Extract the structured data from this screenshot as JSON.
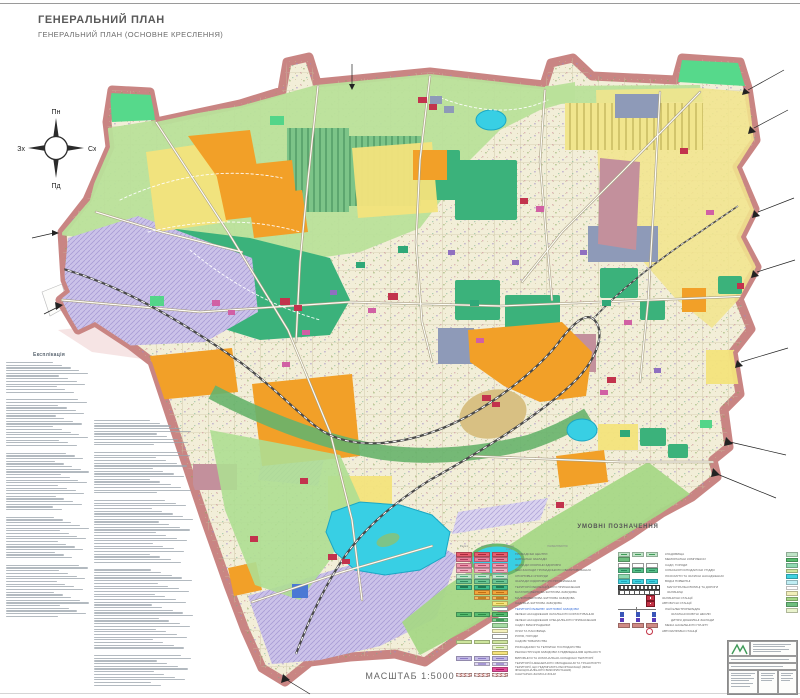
{
  "header": {
    "title": "ГЕНЕРАЛЬНИЙ ПЛАН",
    "subtitle": "ГЕНЕРАЛЬНИЙ ПЛАН (ОСНОВНЕ КРЕСЛЕННЯ)"
  },
  "compass": {
    "north": "Пн",
    "south": "Пд",
    "east": "Сх",
    "west": "Зх"
  },
  "explication": {
    "title": "Експлікація",
    "col1_blocks": [
      12,
      18,
      22,
      16,
      20
    ],
    "col2_blocks": [
      10,
      16,
      24,
      30,
      12
    ]
  },
  "scale": {
    "label": "МАСШТАБ 1:5000"
  },
  "legend": {
    "title": "УМОВНІ ПОЗНАЧЕННЯ",
    "col_headers": [
      "існуючі",
      "на I чергу",
      "на розрах. строк"
    ],
    "label_header": "НАЙМЕНУВАННЯ",
    "left_rows": [
      {
        "c": "#e85d6e",
        "d": "#a8293c",
        "f": [
          1,
          1,
          1
        ],
        "label": "ГРОМАДСЬКІ ЦЕНТРИ"
      },
      {
        "c": "#e87d97",
        "d": "#b03b5c",
        "f": [
          1,
          1,
          1
        ],
        "label": "НАВЧАЛЬНІ ЗАКЛАДИ"
      },
      {
        "c": "#ef97ad",
        "d": "#b8496a",
        "f": [
          1,
          1,
          1
        ],
        "label": "ЗАКЛАДИ ОХОРОНИ ЗДОРОВ'Я"
      },
      {
        "c": "#f3aec0",
        "d": "#c05a78",
        "f": [
          1,
          1,
          1
        ],
        "label": "ІНШІ ЗАКЛАДИ ГРОМАДСЬКОГО ОБСЛУГОВУВАННЯ"
      },
      {
        "c": "#bfe7cb",
        "d": "#4fae7a",
        "f": [
          1,
          1,
          1
        ],
        "label": "СПОРТИВНІ СПОРУДИ"
      },
      {
        "c": "#6cc795",
        "d": "#2f8a5e",
        "f": [
          1,
          1,
          1
        ],
        "label": "ЗАКЛАДИ ОЗДОРОВЧОГО ПРИЗНАЧЕННЯ"
      },
      {
        "c": "#3fbd8b",
        "d": "#1f7a52",
        "f": [
          1,
          1,
          1
        ],
        "label": "ТЕРИТОРІЇ РЕКРЕАЦІЙНОГО ПРИЗНАЧЕННЯ"
      },
      {
        "c": "#f2a43b",
        "d": "#c06f12",
        "f": [
          0,
          1,
          1
        ],
        "label": "БАГАТОПОВЕРХОВА ЖИТЛОВА ЗАБУДОВА"
      },
      {
        "c": "#f4b95c",
        "d": "#c5821f",
        "f": [
          0,
          1,
          1
        ],
        "label": "МАЛОПОВЕРХОВА ЖИТЛОВА ЗАБУДОВА"
      },
      {
        "c": "#f6e47c",
        "d": "#c9ae35",
        "f": [
          0,
          0,
          1
        ],
        "label": "САДИБНА ЖИТЛОВА ЗАБУДОВА"
      },
      {
        "c": "#ffffff",
        "d": "",
        "f": [
          0,
          0,
          1
        ],
        "blue": true,
        "label": "ТЕРИТОРІЇ РЕЗЕРВУ ЖИТЛОВОЇ ЗАБУДОВИ"
      },
      {
        "c": "#57bd6f",
        "d": "#2a8a45",
        "f": [
          1,
          1,
          1
        ],
        "label": "ЗЕЛЕНІ НАСАДЖЕННЯ ЗАГАЛЬНОГО КОРИСТУВАННЯ"
      },
      {
        "c": "#7fcf8f",
        "d": "#3f9a58",
        "f": [
          0,
          0,
          1
        ],
        "label": "ЗЕЛЕНІ НАСАДЖЕННЯ СПЕЦІАЛЬНОГО ПРИЗНАЧЕННЯ"
      },
      {
        "c": "#a6dba4",
        "d": "",
        "f": [
          0,
          0,
          1
        ],
        "label": "САДИ І ВИНОГРАДНИКИ"
      },
      {
        "c": "#f4f0bb",
        "d": "",
        "f": [
          0,
          0,
          1
        ],
        "label": "ЛУКИ ТА ПАСОВИЩА"
      },
      {
        "c": "#ffffff",
        "d": "",
        "f": [
          0,
          0,
          1
        ],
        "label": "РІЛЛЯ, ГОРОДИ"
      },
      {
        "c": "#cde59d",
        "d": "",
        "f": [
          1,
          1,
          1
        ],
        "label": "САДОВІ ТОВАРИСТВА"
      },
      {
        "c": "#e9f3cd",
        "d": "#9cc45e",
        "f": [
          0,
          0,
          1
        ],
        "label": "РОЗСАДНИКИ ТА ТЕПЛИЧНІ ГОСПОДАРСТВА"
      },
      {
        "c": "#f6e47c",
        "d": "",
        "f": [
          0,
          0,
          1
        ],
        "label": "РЕКОНСТРУКЦІЯ ЗАБУДОВИ З ПІДВИЩЕННЯМ ЩІЛЬНОСТІ"
      },
      {
        "c": "#c3b9e6",
        "d": "#8a7bc4",
        "f": [
          1,
          1,
          1
        ],
        "label": "ВИРОБНИЧІ ТА КОМУНАЛЬНО-СКЛАДСЬКІ ТЕРИТОРІЇ"
      },
      {
        "c": "#dcd4f0",
        "d": "#a697d4",
        "f": [
          0,
          1,
          1
        ],
        "label": "ТЕРИТОРІЇ ІНЖЕНЕРНОГО ОБЛАДНАННЯ ТА ТРАНСПОРТУ"
      },
      {
        "c": "#e34f9b",
        "d": "#a8165f",
        "f": [
          0,
          0,
          1
        ],
        "label": "ТЕРИТОРІЇ, ЩО ПІДЛЯГАЮТЬ РЕОРГАНІЗАЦІЇ (ЗМІНІ ФУНКЦІОНАЛЬНОГО ВИКОРИСТАННЯ)"
      },
      {
        "c": "#cf8a85",
        "d": "",
        "f": [
          1,
          1,
          1
        ],
        "hatch": true,
        "label": "САНІТАРНО-ЗАХИСНІ ЗОНИ"
      }
    ],
    "right_rows": [
      {
        "type": "sw3",
        "c": "#bfe4c7",
        "d": "#3f9a58",
        "label": "КЛАДОВИЩА"
      },
      {
        "type": "sw1",
        "c": "#6fbf7f",
        "d": "",
        "label": "МЕМОРІАЛЬНІ КОМПЛЕКСИ"
      },
      {
        "type": "sw3o",
        "c": "#ffffff",
        "d": "",
        "label": "САДИ, ГОРОДИ"
      },
      {
        "type": "sw3",
        "c": "#57c08a",
        "d": "#2a8a5e",
        "label": "СІЛЬСЬКОГОСПОДАРСЬКІ УГІДДЯ"
      },
      {
        "type": "sw1",
        "c": "#8fd9b0",
        "d": "",
        "label": "ЛІСОСМУГИ ТА ЗАХИСНІ НАСАДЖЕННЯ"
      },
      {
        "type": "sw3",
        "c": "#3fd2e0",
        "d": "#1fa8be",
        "label": "ВОДНІ ПОВЕРХНІ"
      },
      {
        "type": "road",
        "label": "МАГІСТРАЛЬНІ ВУЛИЦІ ТА ДОРОГИ"
      },
      {
        "type": "rail",
        "label": "ЗАЛІЗНИЦІ"
      },
      {
        "type": "sym",
        "label": "ЗАЛІЗНИЧНІ СТАНЦІЇ"
      },
      {
        "type": "sym",
        "label": "АВТОБУСНІ СТАНЦІЇ"
      },
      {
        "type": "line",
        "label": "ЛІНІЇ ЕЛЕКТРОПЕРЕДАЧ"
      },
      {
        "type": "sq",
        "c": "#3a55b8",
        "label": "ЗАГАЛЬНООСВІТНІ ШКОЛИ"
      },
      {
        "type": "sq",
        "c": "#5a3ab8",
        "label": "ДИТЯЧІ ДОШКІЛЬНІ ЗАКЛАДИ"
      },
      {
        "type": "border",
        "c": "#cf8a85",
        "label": "МЕЖА НАСЕЛЕНОГО ПУНКТУ"
      },
      {
        "type": "fuel",
        "label": "АВТОЗАПРАВНІ СТАНЦІЇ"
      }
    ],
    "extra_swatches": [
      "#bfe4c7",
      "#57bd6f",
      "#8fd9b0",
      "#cde59d",
      "#3fd2e0",
      "#bfeef4",
      "#ffffff",
      "#f2efb9",
      "#a6d787",
      "#6fbf7f",
      "#e9f3cd"
    ]
  },
  "map_colors": {
    "boundary_band": "#c98583",
    "base_fabric": "#f2eed8",
    "park_green": "#b9e09a",
    "forest_teal": "#3bb27b",
    "allotment_green": "#7cc488",
    "residential_yellow": "#f3e37c",
    "multistorey_orange": "#f2a028",
    "industrial_lavender": "#cbc2e9",
    "utility_slate": "#8e9ab8",
    "public_red": "#c2334d",
    "mixed_mauve": "#c3909c",
    "water_cyan": "#38cfe4",
    "railway_dark": "#4a4a4a"
  }
}
